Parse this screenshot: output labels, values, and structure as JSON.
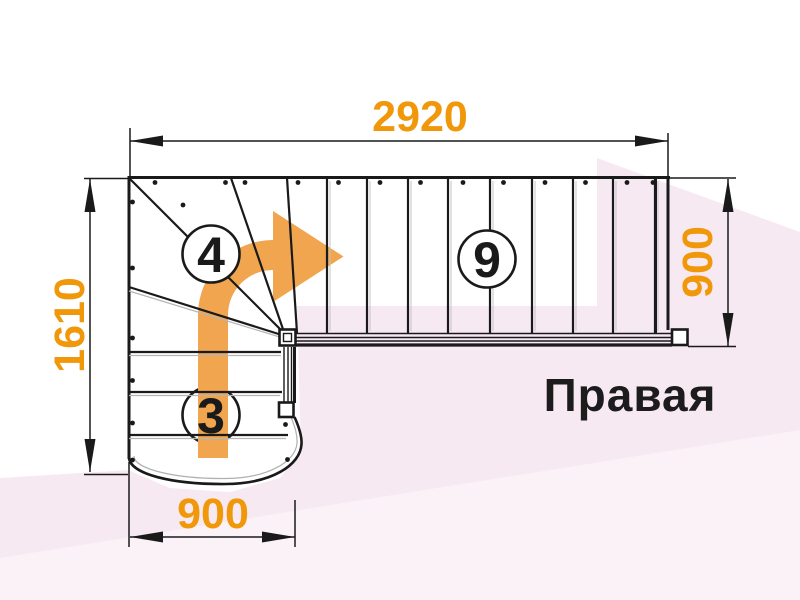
{
  "drawing": {
    "type_label": "staircase-plan-top-view",
    "orientation_label": "Правая",
    "dimensions": {
      "top": "2920",
      "left": "1610",
      "right": "900",
      "bottom": "900"
    },
    "step_counts": {
      "straight_flight": "9",
      "winder_flight": "4",
      "lower_flight": "3"
    },
    "colors": {
      "dimension_orange": "#F0970A",
      "arrow_orange": "#F0A54E",
      "line_black": "#1A1A1A",
      "background_pink": "#F7E9F2",
      "background_pink_light": "#FBF2F8",
      "title_black": "#1C1C1C"
    },
    "icons": {
      "direction_arrow": "curved-up-then-right-arrow"
    }
  }
}
